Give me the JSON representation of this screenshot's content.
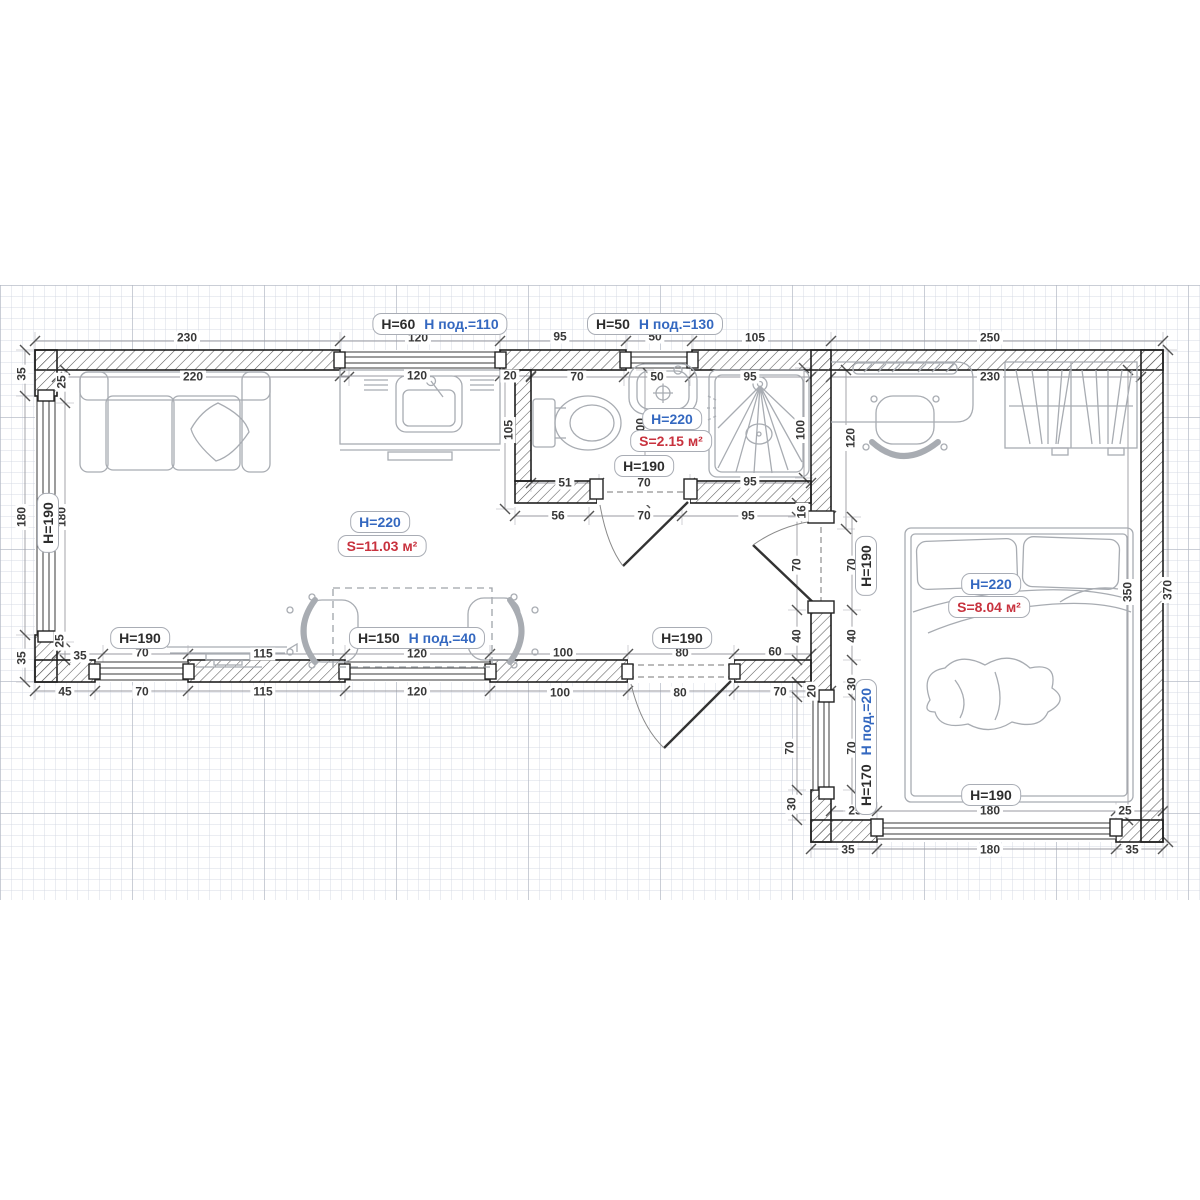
{
  "colors": {
    "black_text": "#2d2d2d",
    "blue_text": "#3468c0",
    "red_text": "#c8323e",
    "wall_line": "#1f1f1f",
    "furniture_line": "#a8acb2",
    "dim_line": "#9a9aa0"
  },
  "rooms": [
    {
      "name": "living-room",
      "height_note": "H=220",
      "area_note": "S=11.03 м²"
    },
    {
      "name": "bathroom",
      "height_note": "H=220",
      "area_note": "S=2.15 м²"
    },
    {
      "name": "bedroom",
      "height_note": "H=220",
      "area_note": "S=8.04 м²"
    }
  ],
  "dim_labels": [
    {
      "t": "230",
      "x": 187,
      "y": 338
    },
    {
      "t": "120",
      "x": 418,
      "y": 338
    },
    {
      "t": "95",
      "x": 560,
      "y": 337
    },
    {
      "t": "50",
      "x": 655,
      "y": 337
    },
    {
      "t": "105",
      "x": 755,
      "y": 338
    },
    {
      "t": "250",
      "x": 990,
      "y": 338
    },
    {
      "t": "220",
      "x": 193,
      "y": 377
    },
    {
      "t": "120",
      "x": 417,
      "y": 376
    },
    {
      "t": "20",
      "x": 510,
      "y": 376
    },
    {
      "t": "70",
      "x": 577,
      "y": 377
    },
    {
      "t": "50",
      "x": 657,
      "y": 377
    },
    {
      "t": "95",
      "x": 750,
      "y": 377
    },
    {
      "t": "230",
      "x": 990,
      "y": 377
    },
    {
      "t": "35",
      "x": 22,
      "y": 374,
      "r": -90
    },
    {
      "t": "180",
      "x": 22,
      "y": 517,
      "r": -90
    },
    {
      "t": "35",
      "x": 22,
      "y": 658,
      "r": -90
    },
    {
      "t": "25",
      "x": 62,
      "y": 382,
      "r": -90
    },
    {
      "t": "180",
      "x": 62,
      "y": 517,
      "r": -90
    },
    {
      "t": "25",
      "x": 60,
      "y": 641,
      "r": -90
    },
    {
      "t": "35",
      "x": 80,
      "y": 656
    },
    {
      "t": "105",
      "x": 509,
      "y": 430,
      "r": -90
    },
    {
      "t": "100",
      "x": 641,
      "y": 428,
      "r": -90
    },
    {
      "t": "100",
      "x": 801,
      "y": 430,
      "r": -90
    },
    {
      "t": "120",
      "x": 851,
      "y": 438,
      "r": -90
    },
    {
      "t": "16",
      "x": 802,
      "y": 512,
      "r": -90
    },
    {
      "t": "51",
      "x": 565,
      "y": 483
    },
    {
      "t": "70",
      "x": 644,
      "y": 483
    },
    {
      "t": "95",
      "x": 750,
      "y": 482
    },
    {
      "t": "56",
      "x": 558,
      "y": 516
    },
    {
      "t": "70",
      "x": 644,
      "y": 516
    },
    {
      "t": "95",
      "x": 748,
      "y": 516
    },
    {
      "t": "70",
      "x": 797,
      "y": 565,
      "r": -90
    },
    {
      "t": "70",
      "x": 852,
      "y": 565,
      "r": -90
    },
    {
      "t": "40",
      "x": 797,
      "y": 636,
      "r": -90
    },
    {
      "t": "40",
      "x": 852,
      "y": 636,
      "r": -90
    },
    {
      "t": "30",
      "x": 852,
      "y": 684,
      "r": -90
    },
    {
      "t": "70",
      "x": 790,
      "y": 748,
      "r": -90
    },
    {
      "t": "70",
      "x": 852,
      "y": 748,
      "r": -90
    },
    {
      "t": "30",
      "x": 792,
      "y": 804,
      "r": -90
    },
    {
      "t": "20",
      "x": 812,
      "y": 691,
      "r": -90
    },
    {
      "t": "350",
      "x": 1128,
      "y": 592,
      "r": -90
    },
    {
      "t": "370",
      "x": 1168,
      "y": 590,
      "r": -90
    },
    {
      "t": "70",
      "x": 142,
      "y": 653
    },
    {
      "t": "115",
      "x": 263,
      "y": 654
    },
    {
      "t": "120",
      "x": 417,
      "y": 654
    },
    {
      "t": "100",
      "x": 563,
      "y": 653
    },
    {
      "t": "80",
      "x": 682,
      "y": 653
    },
    {
      "t": "60",
      "x": 775,
      "y": 652
    },
    {
      "t": "45",
      "x": 65,
      "y": 692
    },
    {
      "t": "70",
      "x": 142,
      "y": 692
    },
    {
      "t": "115",
      "x": 263,
      "y": 692
    },
    {
      "t": "120",
      "x": 417,
      "y": 692
    },
    {
      "t": "100",
      "x": 560,
      "y": 693
    },
    {
      "t": "80",
      "x": 680,
      "y": 693
    },
    {
      "t": "70",
      "x": 780,
      "y": 692
    },
    {
      "t": "25",
      "x": 855,
      "y": 811
    },
    {
      "t": "180",
      "x": 990,
      "y": 811
    },
    {
      "t": "25",
      "x": 1125,
      "y": 811
    },
    {
      "t": "35",
      "x": 848,
      "y": 850
    },
    {
      "t": "180",
      "x": 990,
      "y": 850
    },
    {
      "t": "35",
      "x": 1132,
      "y": 850
    }
  ],
  "badge_labels": [
    {
      "parts": [
        {
          "t": "H=60",
          "c": "k"
        },
        {
          "t": "H под.=110",
          "c": "b"
        }
      ],
      "x": 440,
      "y": 324
    },
    {
      "parts": [
        {
          "t": "H=50",
          "c": "k"
        },
        {
          "t": "H под.=130",
          "c": "b"
        }
      ],
      "x": 655,
      "y": 324
    },
    {
      "parts": [
        {
          "t": "H=220",
          "c": "b"
        }
      ],
      "x": 380,
      "y": 522
    },
    {
      "parts": [
        {
          "t": "S=11.03 м²",
          "c": "r"
        }
      ],
      "x": 382,
      "y": 546
    },
    {
      "parts": [
        {
          "t": "H=220",
          "c": "b"
        }
      ],
      "x": 672,
      "y": 419
    },
    {
      "parts": [
        {
          "t": "S=2.15 м²",
          "c": "r"
        }
      ],
      "x": 671,
      "y": 441
    },
    {
      "parts": [
        {
          "t": "H=190",
          "c": "k"
        }
      ],
      "x": 644,
      "y": 466
    },
    {
      "parts": [
        {
          "t": "H=220",
          "c": "b"
        }
      ],
      "x": 991,
      "y": 584
    },
    {
      "parts": [
        {
          "t": "S=8.04 м²",
          "c": "r"
        }
      ],
      "x": 989,
      "y": 607
    },
    {
      "parts": [
        {
          "t": "H=190",
          "c": "k"
        }
      ],
      "x": 991,
      "y": 795
    },
    {
      "parts": [
        {
          "t": "H=190",
          "c": "k"
        }
      ],
      "x": 140,
      "y": 638
    },
    {
      "parts": [
        {
          "t": "H=150",
          "c": "k"
        },
        {
          "t": "H под.=40",
          "c": "b"
        }
      ],
      "x": 417,
      "y": 638
    },
    {
      "parts": [
        {
          "t": "H=190",
          "c": "k"
        }
      ],
      "x": 682,
      "y": 638
    },
    {
      "parts": [
        {
          "t": "H=190",
          "c": "k"
        }
      ],
      "x": 48,
      "y": 523,
      "r": -90
    },
    {
      "parts": [
        {
          "t": "H=190",
          "c": "k"
        }
      ],
      "x": 866,
      "y": 566,
      "r": -90
    },
    {
      "parts": [
        {
          "t": "H=170",
          "c": "k"
        },
        {
          "t": "H под.=20",
          "c": "b"
        }
      ],
      "x": 866,
      "y": 747,
      "r": -90
    }
  ]
}
